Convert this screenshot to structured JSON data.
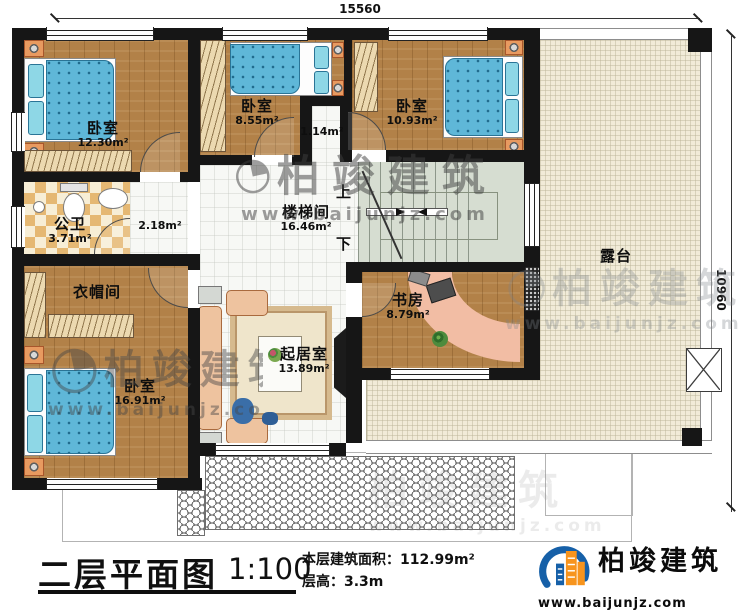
{
  "plan": {
    "dim_top": "15560",
    "dim_right": "10960",
    "stair_up": "上",
    "stair_down": "下",
    "rooms": {
      "bedroom_tl": {
        "name": "卧室",
        "area": "12.30m²"
      },
      "bedroom_tm": {
        "name": "卧室",
        "area": "8.55m²"
      },
      "bedroom_tr": {
        "name": "卧室",
        "area": "10.93m²"
      },
      "bath": {
        "name": "公卫",
        "area": "3.71m²"
      },
      "hall_small": {
        "area": "2.18m²"
      },
      "vestibule": {
        "area": "1.14m²"
      },
      "stairwell": {
        "name": "楼梯间",
        "area": "16.46m²"
      },
      "cloakroom": {
        "name": "衣帽间"
      },
      "bedroom_bl": {
        "name": "卧室",
        "area": "16.91m²"
      },
      "living": {
        "name": "起居室",
        "area": "13.89m²"
      },
      "study": {
        "name": "书房",
        "area": "8.79m²"
      },
      "terrace": {
        "name": "露台"
      }
    },
    "watermark": {
      "name": "柏竣建筑",
      "url": "www.baijunjz.com"
    }
  },
  "title_block": {
    "title": "二层平面图",
    "scale": "1:100",
    "area_label": "本层建筑面积：",
    "area_value": "112.99m²",
    "height_label": "层高：",
    "height_value": "3.3m"
  },
  "brand": {
    "name": "柏竣建筑",
    "url": "www.baijunjz.com"
  },
  "colors": {
    "wall": "#161616",
    "wood": "#b28148",
    "bed_blue": "#5fb7d8",
    "terrace": "#f1ebd8",
    "stair": "#d6ddd1",
    "checker_tan": "#e5b873",
    "brand_blue": "#1660a8",
    "brand_orange": "#f7941d"
  }
}
